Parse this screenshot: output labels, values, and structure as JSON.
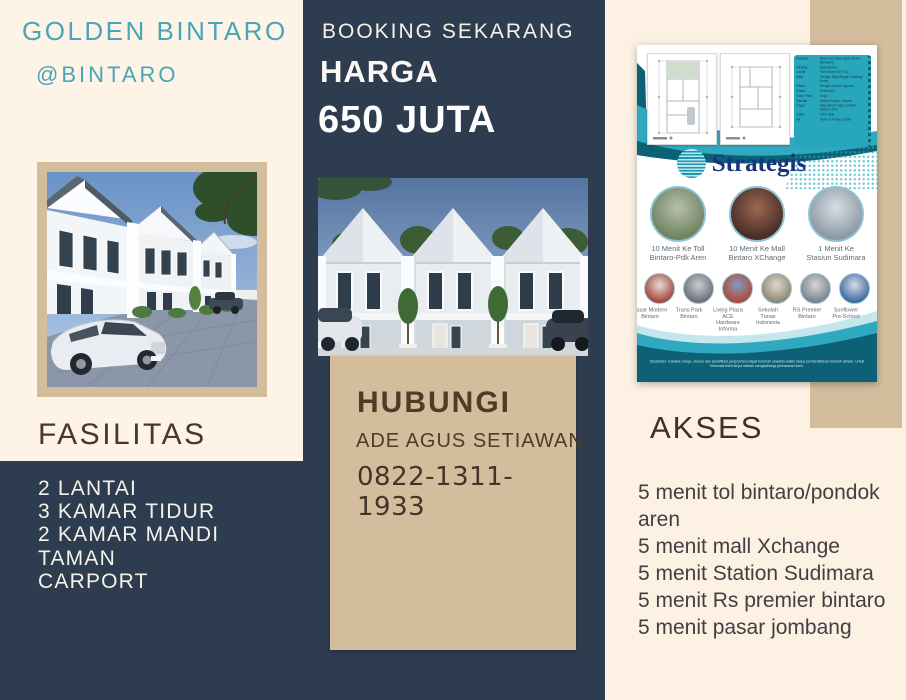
{
  "colors": {
    "navy": "#2d3c4e",
    "cream_left": "#fdf3e6",
    "cream_right": "#fcf1e3",
    "tan": "#d3bd9d",
    "teal_heading": "#4aa5b6",
    "brown_heading": "#4a3726",
    "contact_text": "#4e3b28",
    "light_text": "#f6f1e9",
    "akses_text": "#413f41",
    "akses_heading": "#3d3223",
    "flyer_teal": "#28a7bc",
    "flyer_teal_dark": "#0d6176",
    "strategis_blue": "#15357c"
  },
  "left_panel": {
    "title": "GOLDEN BINTARO",
    "subtitle": "@BINTARO",
    "fasilitas_heading": "FASILITAS",
    "fasilitas_items": [
      "2 LANTAI",
      "3 KAMAR TIDUR",
      "2 KAMAR MANDI",
      "TAMAN",
      "CARPORT"
    ]
  },
  "center_panel": {
    "booking_label": "BOOKING SEKARANG",
    "harga_label": "HARGA",
    "price": "650 JUTA",
    "contact": {
      "heading": "HUBUNGI",
      "name": "ADE AGUS SETIAWAN",
      "phone": "0822-1311-1933"
    }
  },
  "right_panel": {
    "flyer": {
      "strategis_title": "Strategis",
      "spec_rows": [
        {
          "label": "Pondasi",
          "value": "Batu Kali Cakar Ayam Beton Bertulang"
        },
        {
          "label": "Dinding",
          "value": "Bata Merah"
        },
        {
          "label": "Lantai",
          "value": "Full Granite 60 X 60"
        },
        {
          "label": "Atap",
          "value": "Rangka Baja Ringan Genteng Beton"
        },
        {
          "label": "Plafon",
          "value": "Rangka Hollow Gypsum"
        },
        {
          "label": "Kusen",
          "value": "Aluminium"
        },
        {
          "label": "Daun Pintu",
          "value": "Kayu"
        },
        {
          "label": "Sanitair",
          "value": "Klosed Duduk, Shower"
        },
        {
          "label": "Dapur",
          "value": "Meja Beton Lapis Granite, Kitchen Zink"
        },
        {
          "label": "Listrik",
          "value": "1300 Watt"
        },
        {
          "label": "Air",
          "value": "Toren & Pompa Listrik"
        }
      ],
      "landmarks_large": [
        {
          "caption": "10 Menit Ke Toll Bintaro-Pdk Aren",
          "c1": "#6f8461",
          "c2": "#b8bfae"
        },
        {
          "caption": "10 Menit Ke Mall Bintaro XChange",
          "c1": "#4a2c28",
          "c2": "#9a6a50"
        },
        {
          "caption": "1 Menit Ke Stasiun Sudimara",
          "c1": "#8d9aa6",
          "c2": "#d8dee4"
        }
      ],
      "landmarks_small": [
        {
          "caption": "Pasar Modern Bintaro",
          "c1": "#a8453c",
          "c2": "#e2ddd4"
        },
        {
          "caption": "Trans Park Bintaro",
          "c1": "#6e7178",
          "c2": "#c9ccd2"
        },
        {
          "caption": "Living Plaza ACE Hardware Informa",
          "c1": "#b04a38",
          "c2": "#7e9ec0"
        },
        {
          "caption": "Sekolah Tunas Indonesia",
          "c1": "#8e8878",
          "c2": "#ded9cc"
        },
        {
          "caption": "RS Premier Bintaro",
          "c1": "#7d828c",
          "c2": "#d4d7dc"
        },
        {
          "caption": "Sunflower Pre-School",
          "c1": "#3f6ba2",
          "c2": "#d7dde6"
        }
      ],
      "disclaimer": "Disclaimer: Gambar, harga, ukuran dan spesifikasi yang tertera dapat berubah sewaktu-waktu tanpa pemberitahuan terlebih dahulu. Untuk informasi lebih lanjut silakan menghubungi pemasaran kami."
    },
    "akses_heading": "AKSES",
    "akses_items": [
      "5 menit tol bintaro/pondok aren",
      "5 menit mall Xchange",
      "5 menit Station Sudimara",
      "5 menit Rs premier bintaro",
      "5 menit pasar jombang"
    ]
  }
}
